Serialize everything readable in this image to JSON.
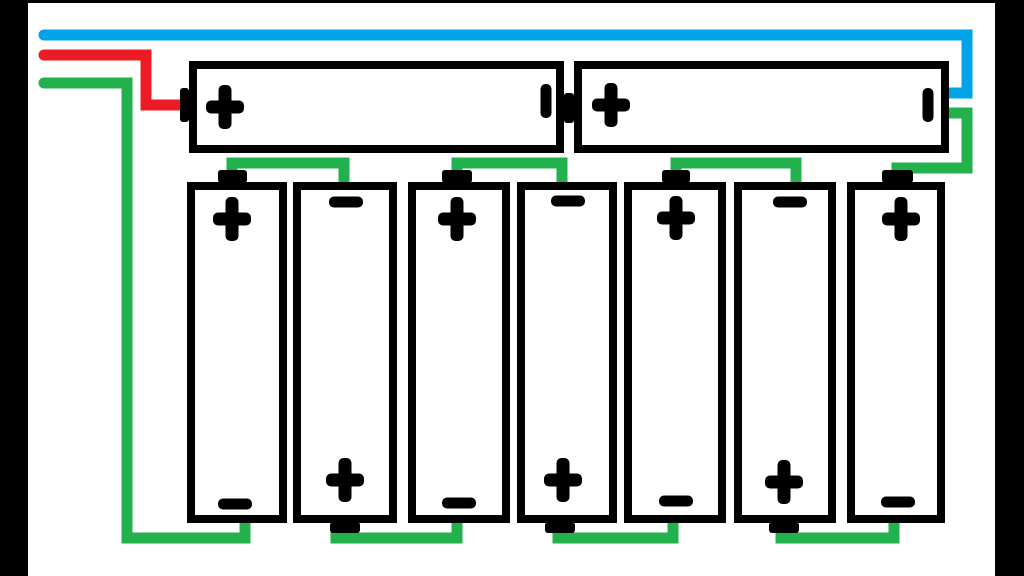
{
  "app": {
    "title": "series-battery-wiring-diagram"
  },
  "colors": {
    "paper": "#ffffff",
    "ink": "#000000",
    "wire_blue": "#00a2e8",
    "wire_red": "#ed1c24",
    "wire_green": "#22b14c"
  },
  "canvas": {
    "width": 1024,
    "height": 576
  },
  "frame": {
    "bars": [
      {
        "name": "frame-left-bar",
        "x": 0,
        "y": 0,
        "w": 28,
        "h": 576
      },
      {
        "name": "frame-right-bar",
        "x": 995,
        "y": 0,
        "w": 29,
        "h": 576
      },
      {
        "name": "frame-top-bar",
        "x": 0,
        "y": 0,
        "w": 1024,
        "h": 3
      }
    ]
  },
  "symbol_sizes": {
    "plus": {
      "w": 38,
      "h": 44,
      "t": 13
    },
    "minus": {
      "l": 34,
      "t": 11
    }
  },
  "wires": [
    {
      "name": "blue-negative-lead-wire",
      "color": "wire_blue",
      "width": 11,
      "points": [
        [
          44,
          35
        ],
        [
          967,
          35
        ],
        [
          967,
          93
        ],
        [
          945,
          93
        ]
      ]
    },
    {
      "name": "red-positive-lead-wire",
      "color": "wire_red",
      "width": 11,
      "points": [
        [
          44,
          55
        ],
        [
          146,
          55
        ],
        [
          146,
          105
        ],
        [
          184,
          105
        ]
      ]
    },
    {
      "name": "green-lead-wire-left-long",
      "color": "wire_green",
      "width": 11,
      "points": [
        [
          44,
          83
        ],
        [
          127,
          83
        ],
        [
          127,
          538
        ],
        [
          245,
          538
        ],
        [
          245,
          520
        ]
      ]
    },
    {
      "name": "green-jumper-top-cell1-cell2",
      "color": "wire_green",
      "width": 11,
      "points": [
        [
          232,
          175
        ],
        [
          232,
          163
        ],
        [
          344,
          163
        ],
        [
          344,
          186
        ]
      ]
    },
    {
      "name": "green-jumper-top-cell3-cell4",
      "color": "wire_green",
      "width": 11,
      "points": [
        [
          457,
          175
        ],
        [
          457,
          163
        ],
        [
          562,
          163
        ],
        [
          562,
          186
        ]
      ]
    },
    {
      "name": "green-jumper-top-cell5-cell6",
      "color": "wire_green",
      "width": 11,
      "points": [
        [
          676,
          175
        ],
        [
          676,
          163
        ],
        [
          796,
          163
        ],
        [
          796,
          186
        ]
      ]
    },
    {
      "name": "green-jumper-cell7-to-top-battery",
      "color": "wire_green",
      "width": 11,
      "points": [
        [
          897,
          173
        ],
        [
          897,
          168
        ],
        [
          967,
          168
        ],
        [
          967,
          113
        ],
        [
          945,
          113
        ]
      ]
    },
    {
      "name": "green-jumper-bottom-cell2-cell3",
      "color": "wire_green",
      "width": 11,
      "points": [
        [
          336,
          526
        ],
        [
          336,
          538
        ],
        [
          457,
          538
        ],
        [
          457,
          520
        ]
      ]
    },
    {
      "name": "green-jumper-bottom-cell4-cell5",
      "color": "wire_green",
      "width": 11,
      "points": [
        [
          558,
          526
        ],
        [
          558,
          538
        ],
        [
          673,
          538
        ],
        [
          673,
          520
        ]
      ]
    },
    {
      "name": "green-jumper-bottom-cell6-cell7",
      "color": "wire_green",
      "width": 11,
      "points": [
        [
          781,
          526
        ],
        [
          781,
          538
        ],
        [
          894,
          538
        ],
        [
          894,
          520
        ]
      ]
    }
  ],
  "batteries": [
    {
      "name": "battery-top-left-horizontal",
      "x": 189,
      "y": 61,
      "w": 375,
      "h": 92,
      "border": 8,
      "nubs": [
        {
          "x": 180,
          "y": 88,
          "w": 9,
          "h": 34
        },
        {
          "x": 564,
          "y": 93,
          "w": 10,
          "h": 30
        }
      ],
      "symbols": [
        {
          "icon": "plus",
          "cx": 225,
          "cy": 107
        },
        {
          "icon": "minus",
          "orient": "v",
          "cx": 546,
          "cy": 101
        }
      ]
    },
    {
      "name": "battery-top-right-horizontal",
      "x": 574,
      "y": 61,
      "w": 375,
      "h": 92,
      "border": 8,
      "nubs": [],
      "symbols": [
        {
          "icon": "plus",
          "cx": 611,
          "cy": 105
        },
        {
          "icon": "minus",
          "orient": "v",
          "cx": 928,
          "cy": 105
        }
      ]
    },
    {
      "name": "battery-cell-1-vertical",
      "x": 187,
      "y": 182,
      "w": 100,
      "h": 341,
      "border": 8,
      "nubs": [
        {
          "x": 218,
          "y": 170,
          "w": 29,
          "h": 13
        }
      ],
      "symbols": [
        {
          "icon": "plus",
          "cx": 232,
          "cy": 219
        },
        {
          "icon": "minus",
          "orient": "h",
          "cx": 235,
          "cy": 504
        }
      ]
    },
    {
      "name": "battery-cell-2-vertical",
      "x": 293,
      "y": 182,
      "w": 104,
      "h": 341,
      "border": 8,
      "nubs": [
        {
          "x": 330,
          "y": 522,
          "w": 30,
          "h": 11
        }
      ],
      "symbols": [
        {
          "icon": "minus",
          "orient": "h",
          "cx": 346,
          "cy": 202
        },
        {
          "icon": "plus",
          "cx": 345,
          "cy": 480
        }
      ]
    },
    {
      "name": "battery-cell-3-vertical",
      "x": 408,
      "y": 182,
      "w": 102,
      "h": 341,
      "border": 8,
      "nubs": [
        {
          "x": 442,
          "y": 170,
          "w": 30,
          "h": 13
        }
      ],
      "symbols": [
        {
          "icon": "plus",
          "cx": 457,
          "cy": 219
        },
        {
          "icon": "minus",
          "orient": "h",
          "cx": 459,
          "cy": 503
        }
      ]
    },
    {
      "name": "battery-cell-4-vertical",
      "x": 517,
      "y": 182,
      "w": 100,
      "h": 341,
      "border": 8,
      "nubs": [
        {
          "x": 545,
          "y": 522,
          "w": 30,
          "h": 11
        }
      ],
      "symbols": [
        {
          "icon": "minus",
          "orient": "h",
          "cx": 568,
          "cy": 201
        },
        {
          "icon": "plus",
          "cx": 563,
          "cy": 480
        }
      ]
    },
    {
      "name": "battery-cell-5-vertical",
      "x": 624,
      "y": 182,
      "w": 102,
      "h": 341,
      "border": 8,
      "nubs": [
        {
          "x": 662,
          "y": 170,
          "w": 28,
          "h": 13
        }
      ],
      "symbols": [
        {
          "icon": "plus",
          "cx": 676,
          "cy": 218
        },
        {
          "icon": "minus",
          "orient": "h",
          "cx": 676,
          "cy": 501
        }
      ]
    },
    {
      "name": "battery-cell-6-vertical",
      "x": 734,
      "y": 182,
      "w": 102,
      "h": 341,
      "border": 8,
      "nubs": [
        {
          "x": 769,
          "y": 522,
          "w": 30,
          "h": 11
        }
      ],
      "symbols": [
        {
          "icon": "minus",
          "orient": "h",
          "cx": 790,
          "cy": 202
        },
        {
          "icon": "plus",
          "cx": 784,
          "cy": 482
        }
      ]
    },
    {
      "name": "battery-cell-7-vertical",
      "x": 847,
      "y": 182,
      "w": 98,
      "h": 341,
      "border": 8,
      "nubs": [
        {
          "x": 882,
          "y": 170,
          "w": 31,
          "h": 13
        }
      ],
      "symbols": [
        {
          "icon": "plus",
          "cx": 901,
          "cy": 219
        },
        {
          "icon": "minus",
          "orient": "h",
          "cx": 898,
          "cy": 502
        }
      ]
    }
  ]
}
